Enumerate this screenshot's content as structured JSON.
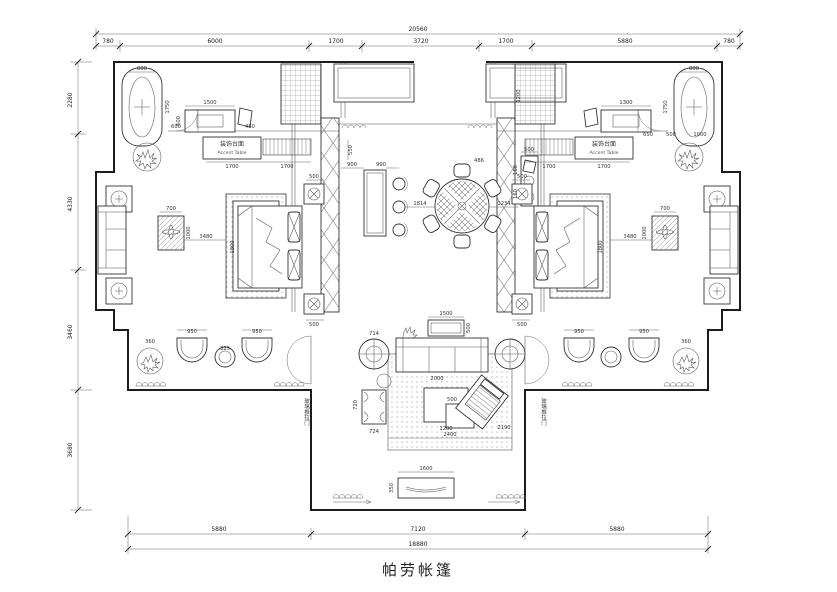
{
  "title_block": {
    "drawing_title": "帕劳帐篷"
  },
  "dims": {
    "top_overall": "20560",
    "top": [
      "780",
      "6000",
      "1700",
      "3720",
      "1700",
      "5880",
      "780"
    ],
    "left": [
      "2280",
      "4330",
      "3460",
      "3680"
    ],
    "bottom": [
      "5880",
      "7120",
      "5880"
    ],
    "bottom_overall": "18880"
  },
  "labels": {
    "accent_left_zh": "装饰台面",
    "accent_left_en": "Accent Table",
    "accent_right_zh": "装饰台面",
    "accent_right_en": "Accent Table",
    "door_left": "玻璃推拉门",
    "door_right": "玻璃推拉门"
  },
  "fd": {
    "tub_w": "800",
    "tub_l": "1750",
    "vanity_l": "1500",
    "vanity_d": "500",
    "wall_l1": "600",
    "wall_l2": "450",
    "dresser_l1": "1700",
    "dresser_l2": "1700",
    "ctable_w": "700",
    "ctable_l": "1000",
    "bed_w": "1800",
    "bed_off": "3480",
    "ns1": "500",
    "ns2": "500",
    "chair1": "950",
    "chair2": "950",
    "plant_l": "360",
    "stool_t": "325",
    "bar_d": "550",
    "bar1": "900",
    "bar2": "990",
    "dine_gap": "1814",
    "dine_chair": "486",
    "hall_gap": "1234",
    "console_w": "500",
    "console_s1": "160",
    "console_s2": "160",
    "sofa_tbl": "1500",
    "sofa_tbl_d": "500",
    "end_tbl": "714",
    "sofa_l": "2000",
    "nest_w": "500",
    "nest_l": "1200",
    "bench": "720",
    "bench2": "724",
    "rug_w": "2400",
    "rug_r": "2190",
    "tv_w": "1600",
    "tv_d": "350",
    "r_tub_w": "800",
    "r_tub_l": "1750",
    "r_vanity": "1300",
    "shower_r": "1200",
    "r_dresser1": "1700",
    "r_dresser2": "1700",
    "wall_r1": "650",
    "wall_r2": "500",
    "wall_r3": "1000",
    "r_ctable_w": "700",
    "r_ctable_l": "1000",
    "r_bed_w": "1800",
    "r_bed_off": "3480",
    "r_ns1": "500",
    "r_ns2": "500",
    "r_chair1": "950",
    "r_chair2": "950",
    "r_plant": "360"
  }
}
